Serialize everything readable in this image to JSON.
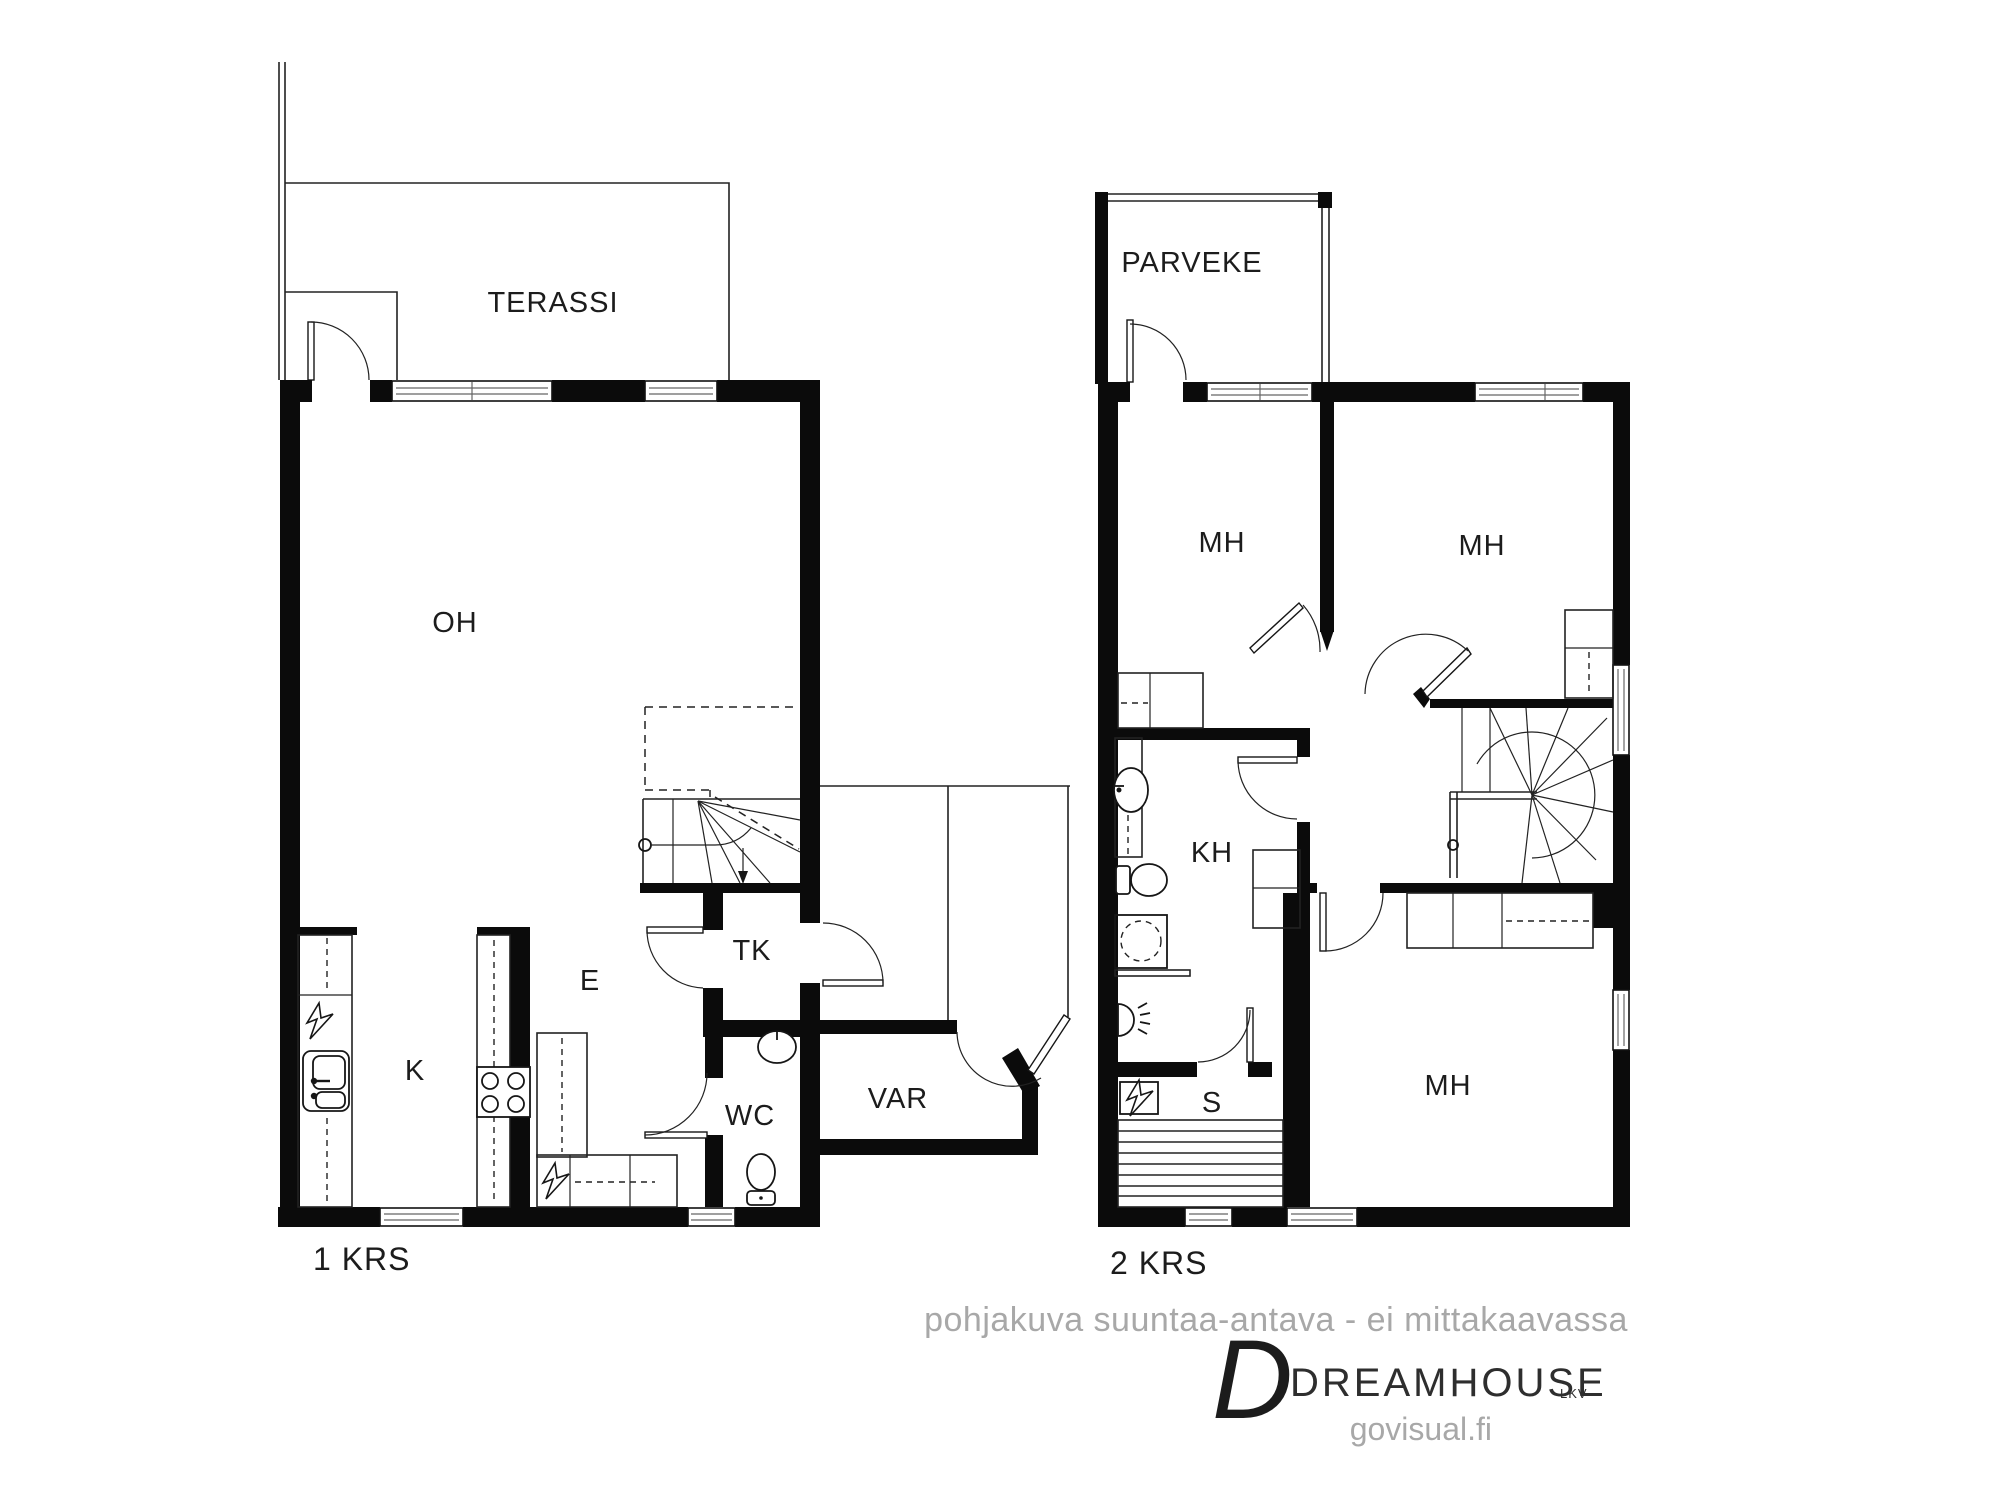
{
  "page": {
    "background": "#ffffff",
    "wall_color": "#0b0b0b",
    "gray_text_color": "#a8a8a8"
  },
  "floor1": {
    "name_label": "1 KRS",
    "rooms": {
      "terassi": "TERASSI",
      "oh": "OH",
      "k": "K",
      "e": "E",
      "tk": "TK",
      "wc": "WC",
      "var": "VAR"
    }
  },
  "floor2": {
    "name_label": "2 KRS",
    "rooms": {
      "parveke": "PARVEKE",
      "mh_top_left": "MH",
      "mh_top_right": "MH",
      "kh": "KH",
      "s": "S",
      "mh_bottom": "MH"
    }
  },
  "footer": {
    "disclaimer": "pohjakuva suuntaa-antava - ei mittakaavassa",
    "brand_initial": "D",
    "brand_name": "DREAMHOUSE",
    "brand_suffix": "LKV",
    "website": "govisual.fi"
  }
}
